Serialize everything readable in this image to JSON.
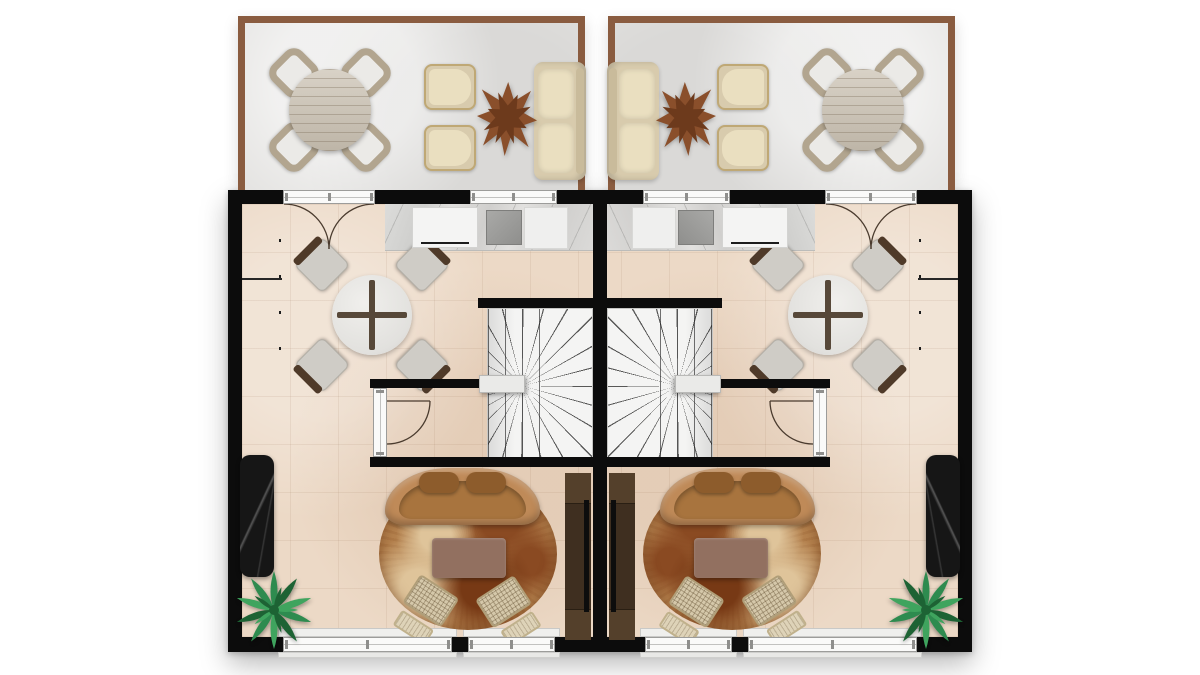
{
  "meta": {
    "description": "Top-down 2D rendered architectural floor plan of a mirrored duplex (two identical units side by side). Ground floor with front terraces, open kitchen-dining area, winder staircase, hallway and living room. No text labels are rendered in the image.",
    "canvas": {
      "width": 1200,
      "height": 675
    },
    "units_count": 2,
    "mirrored_layout": true
  },
  "palette": {
    "page_bg": "#ffffff",
    "wall": "#0c0c0c",
    "terrace_border": "#8a5c40",
    "terrace_floor": "#e3e2e0",
    "floor": "#ecd9c6",
    "counter_marble": "#d9d8d6",
    "cabinet_dark": "#3a3a3a",
    "stair_white": "#f4f4f3",
    "camel": "#bf8a58",
    "camel_dark": "#a8743e",
    "camel_cushion": "#8d5c2c",
    "rug_base": "#b5824e",
    "rug_dark": "#8a4a22",
    "rug_deep": "#773915",
    "rug_light": "#dfc49a",
    "coffee_table": "#927060",
    "woven": "#d5c8aa",
    "tv_wood": "#3f2f20",
    "tv_wood_light": "#54402b",
    "tv_black": "#0d0d0d",
    "black_marble": "#161616",
    "palm_dark": "#1d6334",
    "palm_mid": "#2e8b4f",
    "palm_light": "#3fa45e",
    "star_brown": "#8a4f2b",
    "star_dark": "#6d3a1c",
    "cream_shell": "#d8cbad",
    "cream_cushion": "#eadfc0",
    "terrace_wood": "#ccc3b4",
    "gray_chair": "#cfccc6",
    "chair_back": "#4f3a29",
    "door_line": "#4a3b2e",
    "sink_gray": "#8f8f8d"
  },
  "units": [
    {
      "id": "unit-left",
      "mirrored": false,
      "rooms": {
        "terrace": {
          "furniture": [
            "round-outdoor-dining-table",
            "outdoor-dining-chair x4",
            "outdoor-armchair x2",
            "star-shaped-wood-coffee-table",
            "outdoor-two-seat-sofa"
          ]
        },
        "kitchen_dining": {
          "furniture": [
            "marble-kitchen-counter",
            "cooktop-oven",
            "kitchen-sink",
            "tall-dark-cabinet",
            "round-glass-dining-table",
            "dining-chair x4"
          ],
          "openings": [
            "french-double-door-to-terrace",
            "kitchen-window"
          ]
        },
        "stairs": {
          "furniture": [
            "winder-staircase",
            "stair-landing"
          ]
        },
        "hall": {
          "openings": [
            "interior-swing-door"
          ]
        },
        "living_room": {
          "furniture": [
            "curved-camel-sofa",
            "round-stone-pattern-rug",
            "rectangular-coffee-table",
            "woven-lounge-chair-with-ottoman x2",
            "tv-media-console",
            "wall-mounted-tv",
            "black-marble-console",
            "potted-palm-plant"
          ],
          "openings": [
            "window-large",
            "window-small"
          ]
        }
      }
    },
    {
      "id": "unit-right",
      "mirrored": true,
      "note": "Exact mirror image of unit-left across the central party wall."
    }
  ]
}
